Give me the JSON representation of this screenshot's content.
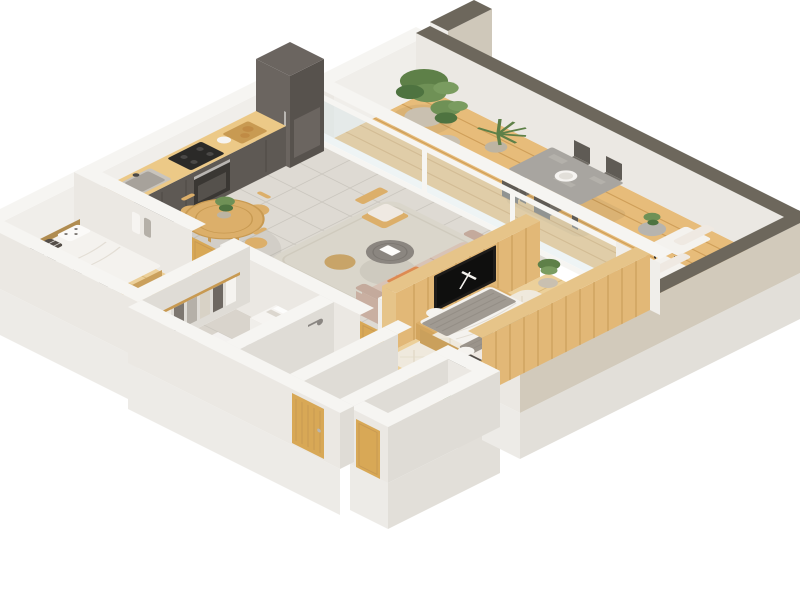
{
  "scene": {
    "title": "3D isometric apartment floor plan render",
    "description": "axonometric cutaway of a one-bedroom-plus apartment with wrap-around wooden terrace",
    "background": "#ffffff"
  },
  "colors": {
    "bg": "#ffffff",
    "wallTop": "#f6f5f2",
    "wallFace": "#ebe8e3",
    "wallFaceDark": "#dfdcd6",
    "wallFaceLight": "#f0eeea",
    "slabFaceSW": "#edebe7",
    "slabFaceSE": "#e2dfd9",
    "parapetTop": "#6d675c",
    "terraceOuter": "#d2cabb",
    "stubBeige": "#cfc8ba",
    "glass": "#d7e4e6",
    "tile": "#dedad3",
    "tileLine": "#ccc8c0",
    "tileHall": "#d9d5cd",
    "bathFloor": "#e4dfd7",
    "wcFloor": "#ddd8d0",
    "dressFloor": "#d9d4cc",
    "bedroomWood": "#ecd09a",
    "bedroomWoodLine": "#d9b878",
    "deck": "#e7bc7a",
    "deckLine": "#cf9e58",
    "wallWoodTop": "#e6c489",
    "wallWood": "#e2b877",
    "wallWoodLine": "#c79a55",
    "furnWood": "#dcaf6a",
    "furnWoodDark": "#c89a52",
    "doorWood": "#d8a856",
    "counterWood": "#ecc987",
    "kDark": "#6b6560",
    "kDarker": "#57524d",
    "kBase": "#5e5954",
    "oven": "#3a3733",
    "steel": "#b9b6b2",
    "cooktop": "#2b2a28",
    "stone": "#a8a5a0",
    "stoneLight": "#b7b4ae",
    "chairDark": "#5f5b55",
    "chairDark2": "#6f6b64",
    "sofa": "#d8c3b6",
    "sofaDark": "#c4aa9c",
    "sofaEnd": "#c9afa1",
    "pillowGray": "#a99d94",
    "pillowWhite": "#efe9e2",
    "throw": "#dd8a52",
    "throwDark": "#c97840",
    "rug": "#dad6cb",
    "rugLine": "#cfcabd",
    "masterRug": "#efe9dd",
    "rugHerring": "#e2dac8",
    "bedWhite": "#f4f2ee",
    "bedBase": "#caa05c",
    "headboard": "#8a6f4a",
    "blanket": "#a09a92",
    "blanketLine": "#938d85",
    "knit": "#9b948b",
    "nstand": "#55504b",
    "nstandFace": "#474340",
    "lamp": "#f5f3ef",
    "green1": "#5e8048",
    "green2": "#6f9156",
    "green3": "#4e7340",
    "green4": "#7a9c60",
    "pot": "#c9c0b0",
    "potDark": "#bdb4a2",
    "white": "#f6f4f1",
    "washer": "#f4f2f0",
    "tv": "#1e1c1a",
    "tvScreen": "#0f0f0e",
    "clothA": "#b5b0a8",
    "clothB": "#6e6862",
    "clothC": "#d8d2c6",
    "clothD": "#7d7770",
    "clothE": "#c5bfb4",
    "polkaDot": "#6a6560",
    "checkPillow": "#544e48",
    "checkLine": "#d8d4cf"
  },
  "rooms": [
    {
      "id": "terrace",
      "floor": "wood-deck",
      "furniture": [
        "stone-dining-table",
        "outdoor-chairs",
        "serving-bowl",
        "lounge-chair",
        "lounge-chair",
        "round-side-table",
        "potted-plant-large",
        "potted-plant-medium",
        "potted-plant-spiky",
        "potted-plant-small"
      ]
    },
    {
      "id": "kitchen",
      "floor": "gray-tile",
      "furniture": [
        "tall-cabinet-fridge",
        "counter-run",
        "sink",
        "faucet",
        "cooktop",
        "oven",
        "cutting-board-with-bread",
        "bowl"
      ]
    },
    {
      "id": "dining-area",
      "floor": "gray-tile",
      "furniture": [
        "round-wood-table",
        "dining-chair",
        "dining-chair",
        "dining-chair",
        "dining-chair",
        "plant-vase"
      ]
    },
    {
      "id": "living-room",
      "floor": "gray-tile",
      "furniture": [
        "area-rug",
        "wood-armchair",
        "round-coffee-table-dark",
        "round-side-table-tan",
        "book",
        "sofa",
        "pillows",
        "orange-throw",
        "half-wall",
        "tv-wood-wall",
        "tv",
        "media-console",
        "sphere-lamp",
        "books"
      ]
    },
    {
      "id": "master-bedroom",
      "floor": "wood-plank",
      "furniture": [
        "cream-rug",
        "double-bed",
        "gray-knit-blanket",
        "knit-pillows",
        "headboard",
        "nightstand",
        "nightstand",
        "sphere-lamp",
        "sphere-lamp",
        "accent-cushions",
        "corner-plant"
      ]
    },
    {
      "id": "bedroom",
      "floor": "wood-plank",
      "furniture": [
        "bed",
        "polka-dot-pillow",
        "check-pillow",
        "open-wardrobe-clothes",
        "wall-hooks-garments"
      ]
    },
    {
      "id": "dressing-room",
      "floor": "stone-tile",
      "furniture": [
        "clothes-rack",
        "dresser",
        "towels",
        "washing-machine"
      ]
    },
    {
      "id": "bathroom",
      "floor": "stone-tile",
      "furniture": [
        "walk-in-shower",
        "floor-drain",
        "glass-screen",
        "shower-head",
        "bench-tub"
      ]
    },
    {
      "id": "wc",
      "floor": "stone-tile",
      "furniture": [
        "toilet",
        "wood-vanity",
        "small-plant"
      ]
    },
    {
      "id": "hallway",
      "floor": "gray-tile",
      "furniture": [
        "front-door"
      ]
    }
  ],
  "structure": {
    "exterior_walls": "white plaster, cut-away tops",
    "terrace_parapet_top": "olive gray",
    "terrace_outer_face": "beige",
    "interior_terrace_divider": "white frame with glass panels",
    "tv_wall": "wood clad",
    "doors": [
      "bedroom-door",
      "bathroom-door",
      "front-door",
      "wc-door"
    ]
  }
}
